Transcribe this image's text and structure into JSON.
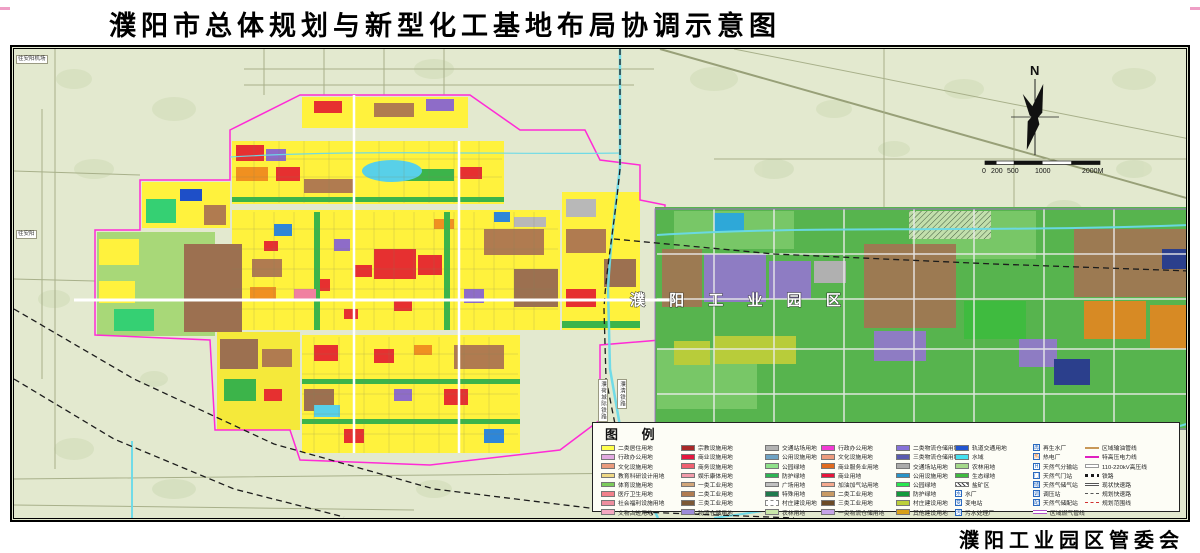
{
  "title": "濮阳市总体规划与新型化工基地布局协调示意图",
  "footer": {
    "agency": "濮阳工业园区管委会"
  },
  "map": {
    "compass_label": "N",
    "scale_ticks": [
      "0",
      "200",
      "500",
      "1000",
      "2000M"
    ],
    "labels": {
      "park_name": "濮 阳 工 业 园 区",
      "rail_intercity": "濮荷城际铁路",
      "rail_line": "濮清铁路",
      "road_top_left": "往安阳机场",
      "road_left": "往安阳"
    },
    "colors": {
      "background": "#e3e9cf",
      "city_boundary": "#ff2bd6",
      "residential_yellow": "#fff23d",
      "park_green": "#57b44e",
      "water_cyan": "#6adae8"
    }
  },
  "legend": {
    "header": "图  例",
    "columns": [
      [
        {
          "label": "二类居住用地",
          "color": "#FFFF4D"
        },
        {
          "label": "行政办公用地",
          "color": "#E2A9E0"
        },
        {
          "label": "文化设施用地",
          "color": "#E99A7C"
        },
        {
          "label": "教育科研设计用地",
          "color": "#EFD884"
        },
        {
          "label": "体育设施用地",
          "color": "#7CCB5A"
        },
        {
          "label": "医疗卫生用地",
          "color": "#F2808A"
        },
        {
          "label": "社会福利设施用地",
          "color": "#EE8E9E"
        },
        {
          "label": "文物古迹用地",
          "color": "#F4A6C0"
        }
      ],
      [
        {
          "label": "宗教设施用地",
          "color": "#A82828"
        },
        {
          "label": "商业设施用地",
          "color": "#E5173F"
        },
        {
          "label": "商务设施用地",
          "color": "#F06070"
        },
        {
          "label": "娱乐康体用地",
          "color": "#F29BAA"
        },
        {
          "label": "一类工业用地",
          "color": "#D2A679"
        },
        {
          "label": "二类工业用地",
          "color": "#B07B50"
        },
        {
          "label": "三类工业用地",
          "color": "#7C5836"
        },
        {
          "label": "物流仓储用地",
          "color": "#9C8BD9"
        }
      ],
      [
        {
          "label": "交通站场用地",
          "color": "#B3B3B3"
        },
        {
          "label": "公用设施用地",
          "color": "#6FA3C4"
        },
        {
          "label": "公园绿地",
          "color": "#8FE08A"
        },
        {
          "label": "防护绿地",
          "color": "#2DB554"
        },
        {
          "label": "广场用地",
          "color": "#C0C0C0"
        },
        {
          "label": "特殊用地",
          "color": "#1F7A4D"
        },
        {
          "label": "村庄建设用地",
          "type": "dashed"
        },
        {
          "label": "农林用地",
          "color": "#C9E8A9"
        }
      ],
      [
        {
          "label": "行政办公用地",
          "color": "#F23BD4"
        },
        {
          "label": "文化设施用地",
          "color": "#EC9B7E"
        },
        {
          "label": "商业服务业用地",
          "color": "#E06A1F"
        },
        {
          "label": "商业用地",
          "color": "#E8143C"
        },
        {
          "label": "加油加气站用地",
          "color": "#F5A98E"
        },
        {
          "label": "二类工业用地",
          "color": "#C89A64"
        },
        {
          "label": "三类工业用地",
          "color": "#6B4A26"
        },
        {
          "label": "一类物流仓储用地",
          "color": "#C5A3E8"
        }
      ],
      [
        {
          "label": "二类物流仓储用地",
          "color": "#8672D8"
        },
        {
          "label": "三类物流仓储用地",
          "color": "#5A5BB0"
        },
        {
          "label": "交通场站用地",
          "color": "#ABABAB"
        },
        {
          "label": "公用设施用地",
          "color": "#2893C8"
        },
        {
          "label": "公园绿地",
          "color": "#27E84F"
        },
        {
          "label": "防护绿地",
          "color": "#129A3C"
        },
        {
          "label": "村庄建设用地",
          "color": "#BCCF3A"
        },
        {
          "label": "其他建设用地",
          "color": "#D8A018"
        }
      ],
      [
        {
          "label": "轨道交通用地",
          "color": "#2255D0"
        },
        {
          "label": "水域",
          "color": "#44E0F0"
        },
        {
          "label": "农林用地",
          "color": "#A5D98A"
        },
        {
          "label": "生态绿地",
          "color": "#3FBB3F"
        },
        {
          "label": "盐矿区",
          "type": "hatch"
        },
        {
          "label": "水厂",
          "type": "icon",
          "glyph": "水"
        },
        {
          "label": "变电站",
          "type": "icon",
          "glyph": "变"
        },
        {
          "label": "污水处理厂",
          "type": "icon",
          "glyph": "污"
        }
      ],
      [
        {
          "label": "再生水厂",
          "type": "icon",
          "glyph": "再"
        },
        {
          "label": "热电厂",
          "type": "icon",
          "glyph": "热",
          "color": "#E87820"
        },
        {
          "label": "天然气分输站",
          "type": "icon",
          "glyph": "H"
        },
        {
          "label": "天然气门站",
          "type": "icon",
          "glyph": "门"
        },
        {
          "label": "天然气储气站",
          "type": "icon",
          "glyph": "储"
        },
        {
          "label": "调压站",
          "type": "icon",
          "glyph": "调"
        },
        {
          "label": "天然气储配站",
          "type": "icon",
          "glyph": "配"
        },
        {
          "label": "区域燃气管线",
          "type": "line2",
          "color": "#B050C8"
        }
      ],
      [
        {
          "label": "区域输油管线",
          "type": "line",
          "color": "#C89858"
        },
        {
          "label": "特高压电力线",
          "type": "line",
          "color": "#E020C0"
        },
        {
          "label": "110-220kV高压线",
          "type": "boxline"
        },
        {
          "label": "铁路",
          "type": "raildash"
        },
        {
          "label": "现状快速路",
          "type": "double"
        },
        {
          "label": "规划快速路",
          "type": "dash",
          "color": "#555555"
        },
        {
          "label": "规划范围线",
          "type": "dash",
          "color": "#D03030"
        }
      ]
    ]
  }
}
